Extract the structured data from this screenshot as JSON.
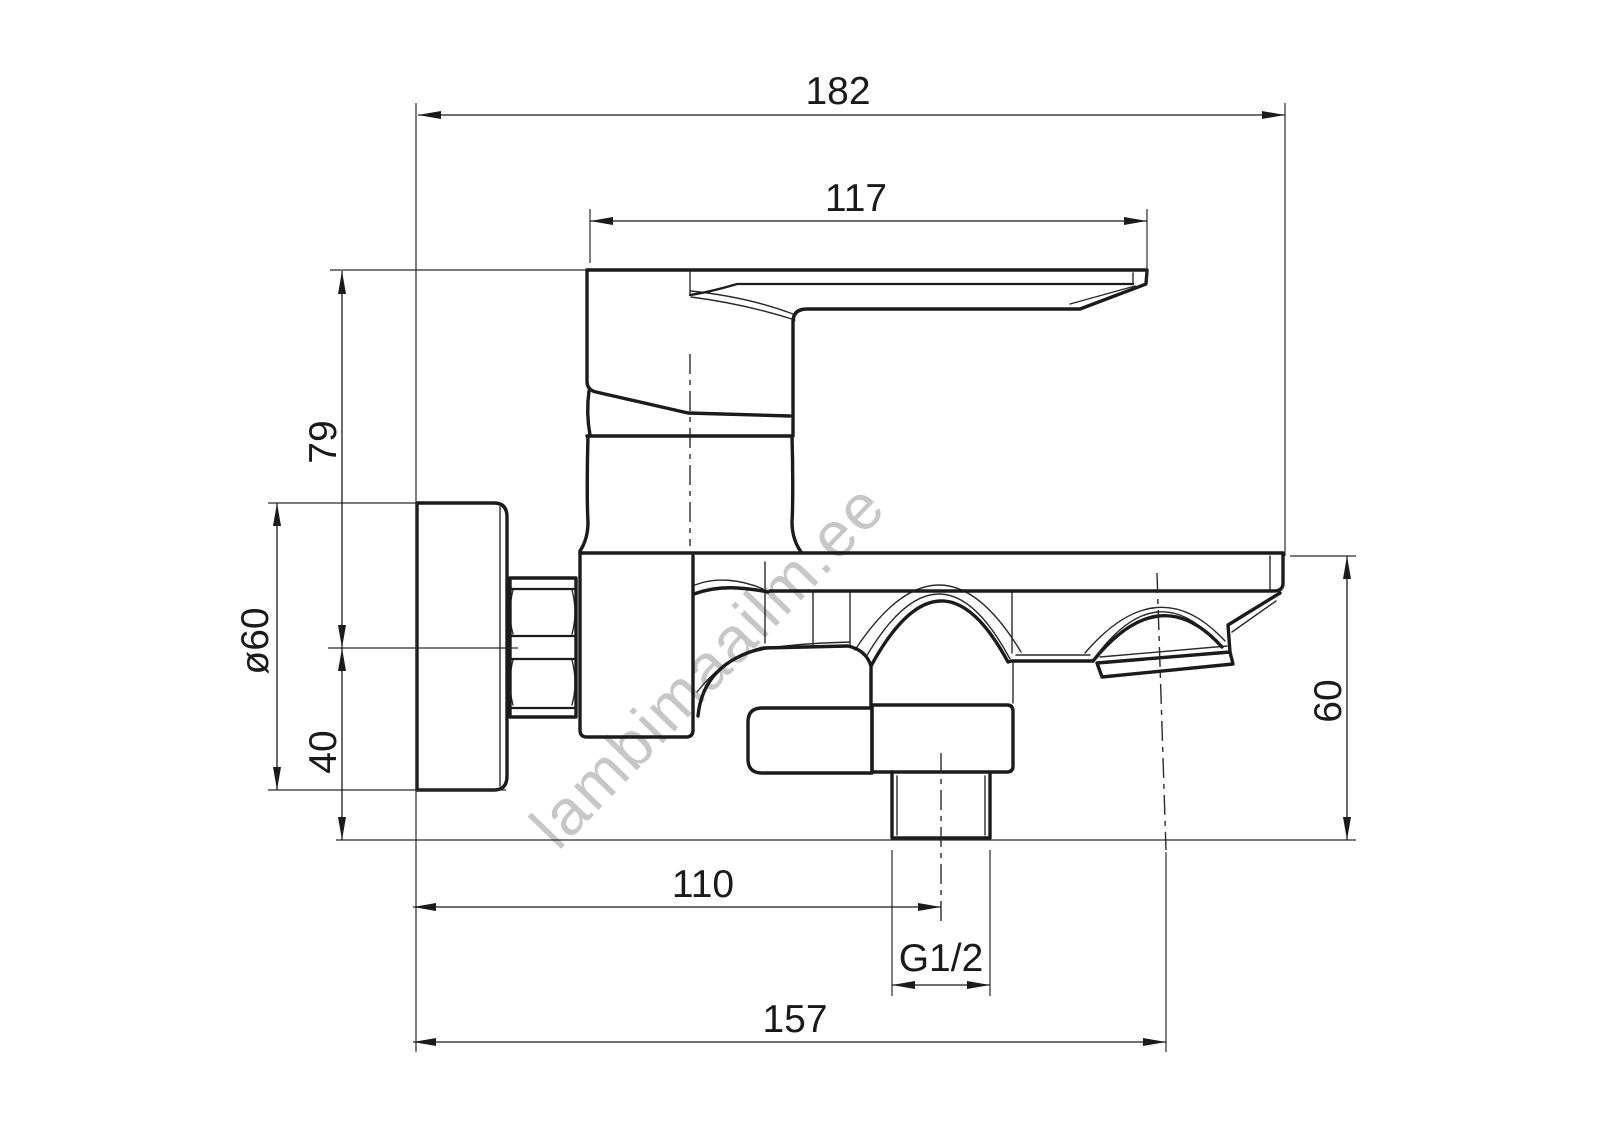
{
  "drawing": {
    "type": "technical-drawing",
    "subject": "wall-mounted single-lever bath mixer faucet, side view",
    "background_color": "#ffffff",
    "line_color": "#1b1b1b"
  },
  "watermark": {
    "text": "lambimaailm.ee",
    "color": "#c7c7c7"
  },
  "dimensions": {
    "overall_length": "182",
    "handle_reach": "117",
    "handle_height": "79",
    "flange_diameter": "ø60",
    "axis_to_flange_bottom": "40",
    "spout_height": "60",
    "wall_to_shower_outlet": "110",
    "thread_size": "G1/2",
    "overall_depth": "157"
  }
}
